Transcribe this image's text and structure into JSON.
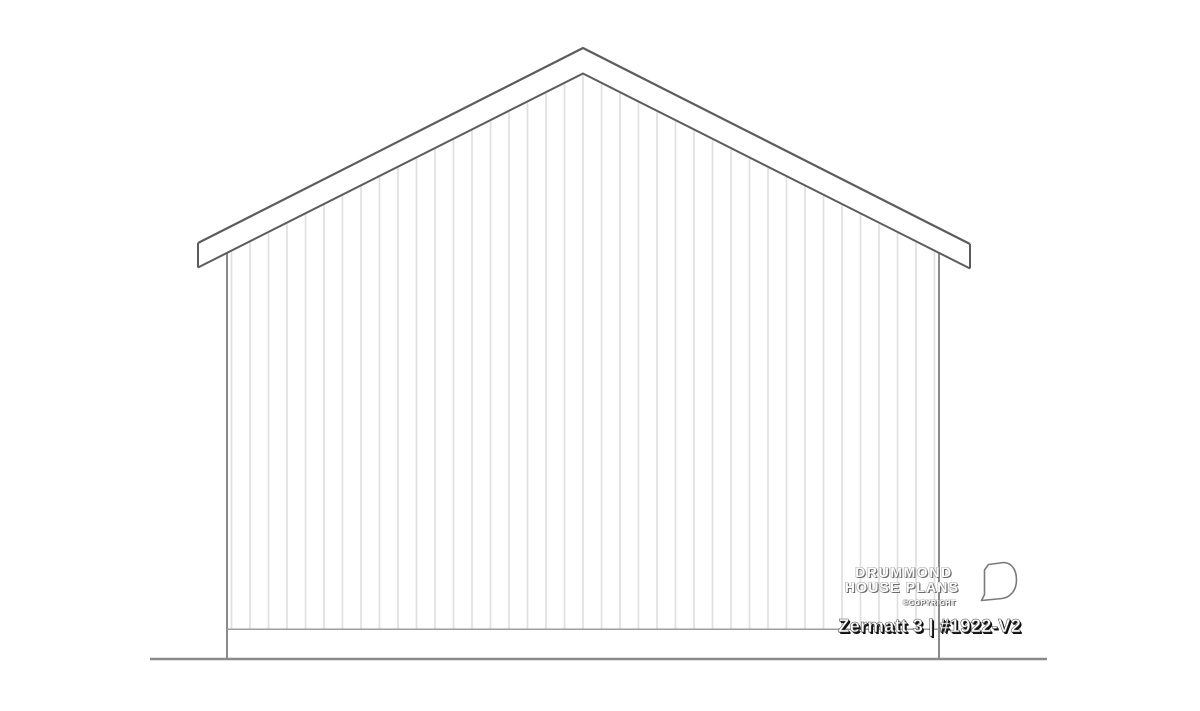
{
  "branding": {
    "name_line1": "DRUMMOND",
    "name_line2": "HOUSE PLANS",
    "copyright_label": "©COPYRIGHT"
  },
  "title_block": {
    "plan_label": "Zermatt 3 | #1922-V2"
  },
  "drawing": {
    "colors": {
      "roof_outline": "#5c5c5c",
      "wall_edge": "#7d7d7d",
      "siding_line": "#e0e0e0",
      "sill_line": "#9e9e9e",
      "ground_line": "#8a8a8a",
      "logo_stroke": "#7a7a7a"
    },
    "geometry": {
      "siding_first_x": 231.5,
      "siding_spacing": 18.5,
      "siding_last_x": 935,
      "peak_x": 583,
      "inner_peak_y": 73.5,
      "roof_slope": 0.5039,
      "siding_bottom_y": 629.3
    }
  }
}
